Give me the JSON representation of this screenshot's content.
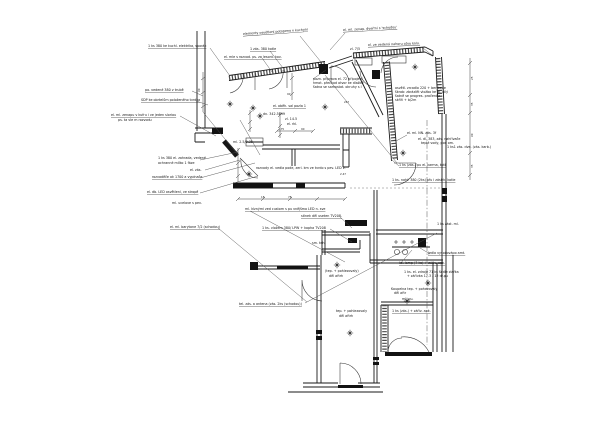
{
  "page": {
    "background": "#ffffff",
    "ink": "#1a1a1a",
    "kind": "electrical floor plan drawing"
  },
  "ann": [
    {
      "t": "1 ks 380 ke kuchl. elektrika, sporák"
    },
    {
      "t": "elementy osvětlení potopeno v kuchyni"
    },
    {
      "t": "1 zás. 380 kotle"
    },
    {
      "t": "el. mle s rozvod. ps. za lesont. kov."
    },
    {
      "t": "el. ml. zenap. dveřmi s 'schodou'"
    },
    {
      "t": "el. ze vedená nahoru otvo kolu."
    },
    {
      "t": "zl. 7/5"
    },
    {
      "t": "po. vedené 380 v trubě"
    },
    {
      "t": "SDP ke obrtelům položeného tvrdka"
    },
    {
      "t": "el. ml. zenapu v kufru i ve jeden sloriau"
    },
    {
      "t": "ps. ta vle m rozvodu"
    },
    {
      "t": "1 ks 380 el. zahrada, vedené"
    },
    {
      "t": "ochranné mlíko 1 fáze"
    },
    {
      "t": "el. zás."
    },
    {
      "t": "rozvaděče ok 1700 a vypínače"
    },
    {
      "t": "el. db. LED osvětlení, ve stropě"
    },
    {
      "t": "ml. ucelove s pev."
    },
    {
      "t": "el. ml. barytone 7/2 (schodou)"
    },
    {
      "t": "rozvody el. vedla pode, zerl. km ve tvrdo s pev. LED v:"
    },
    {
      "t": "ml. klznými zed custom s pu vnějšmo LED n. sve"
    },
    {
      "t": "el. oběh. sal pozla 1"
    },
    {
      "t": "dn. 342.5099"
    },
    {
      "t": "el. rkl."
    },
    {
      "t": "stínek děl useten TV208."
    },
    {
      "t": "1 ks. vložem 380/ LPW + kopha TV208"
    },
    {
      "t": "sm. teh."
    },
    {
      "t": "(tep. + pohlezovaly)"
    },
    {
      "t": "děl ařtrh"
    },
    {
      "t": "tel. zás. a antena (zás. 2ks (schodou))"
    },
    {
      "t": "tep. + pohlezovaly"
    },
    {
      "t": "děl ařtrh"
    },
    {
      "t": "el. ml. NN. zás. 3f"
    },
    {
      "t": "el. dl. 383, zás. nahřívače"
    },
    {
      "t": "teplé vody, pod om."
    },
    {
      "t": "1 ks1 zás. dve. (zás. karb.)"
    },
    {
      "t": "1 ks (zás.) pu el. karma, kotl"
    },
    {
      "t": "1 ks. nahř. 380 (2ks) pfu i zástrk. kotle"
    },
    {
      "t": "1 ks zást. ml."
    },
    {
      "t": "pozn. připrava el. 72 připojení"
    },
    {
      "t": "hmot. přechod otvor ke dlažbě"
    },
    {
      "t": "šatna se samostat. okruhy s l"
    },
    {
      "t": "osvětl. zrcadlo 220 + ber bode"
    },
    {
      "t": "škrab: zbrázlět vložbo ke dl. bílý"
    },
    {
      "t": "šatně se progres. pračenbe"
    },
    {
      "t": "skříň + b/2m"
    },
    {
      "t": "Jedla vysočovápo amt."
    },
    {
      "t": "ks. lamp (7 ks) + zářiv. apk."
    },
    {
      "t": "1 ks. el. zdroje 71 ks šedle zlařka"
    },
    {
      "t": "+ zářivka 17.3 - 12 dr.pu"
    },
    {
      "t": "Koupelna tep. + pohazovaly"
    },
    {
      "t": "děl ařtr"
    },
    {
      "t": "ml. pu."
    },
    {
      "t": "1 ks (zás.) + zářiv. apk."
    },
    {
      "t": "ml. 2.5/9.35"
    },
    {
      "t": "zl. 14.5"
    }
  ],
  "dims": [
    {
      "t": "247"
    },
    {
      "t": "175"
    },
    {
      "t": "90"
    },
    {
      "t": "18"
    },
    {
      "t": "78"
    },
    {
      "t": "2.47"
    },
    {
      "t": "25"
    },
    {
      "t": "35"
    },
    {
      "t": "90"
    },
    {
      "t": "35"
    },
    {
      "t": "90"
    },
    {
      "t": "90"
    }
  ]
}
